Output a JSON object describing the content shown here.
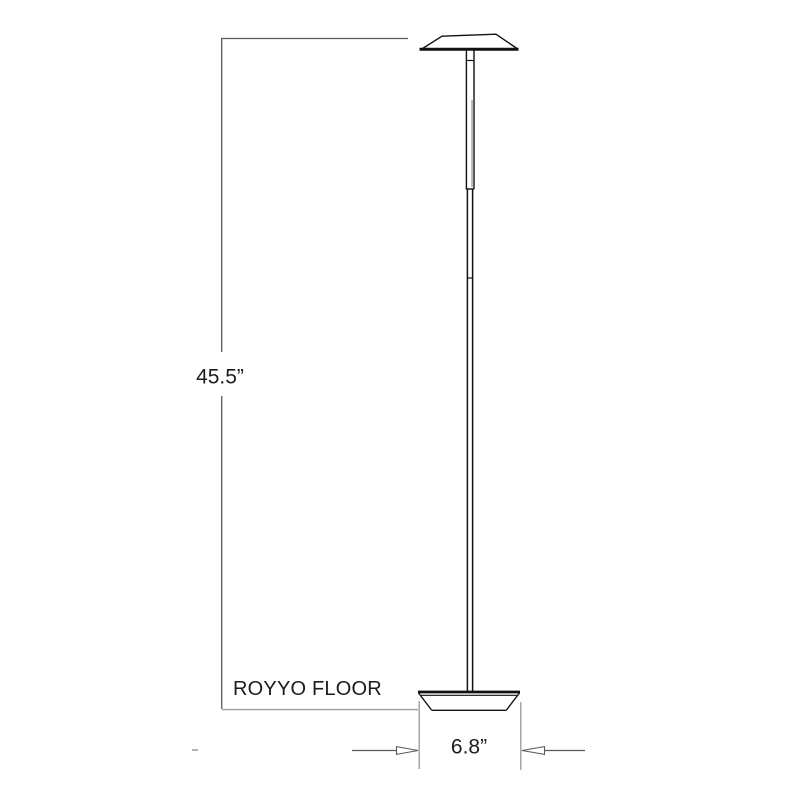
{
  "diagram": {
    "product_name": "ROYYO FLOOR",
    "height_label": "45.5”",
    "base_width_label": "6.8”",
    "height_inches": 45.5,
    "base_width_inches": 6.8
  },
  "colors": {
    "background": "#ffffff",
    "lamp_line": "#111111",
    "dimension_line": "#5a5a5a",
    "extension_line": "#9e9e9e",
    "pole_shading": "#b8b8b8",
    "stray_mark": "#8a8a8a"
  }
}
